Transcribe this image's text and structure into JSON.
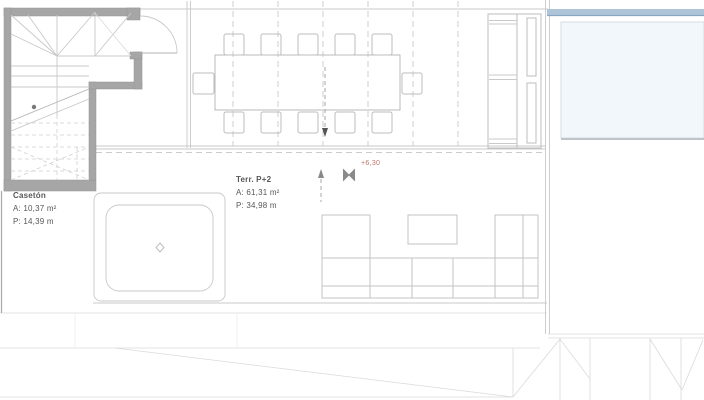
{
  "labels": {
    "caseton": {
      "name": "Casetón",
      "area": "A: 10,37 m²",
      "perimeter": "P: 14,39 m"
    },
    "terrace": {
      "name": "Terr. P+2",
      "area": "A: 61,31 m²",
      "perimeter": "P: 34,98 m"
    },
    "level": "+6,30"
  },
  "icons": {
    "level_marker": "benchmark-bowtie",
    "slope_arrow_down": "arrow-down",
    "slope_arrow_up": "arrow-up",
    "stair_direction": "dot-with-line",
    "jacuzzi_drain": "diamond"
  },
  "colors": {
    "wall_gray": "#a6a6a6",
    "plan_line_gray": "#c9c9c9",
    "level_accent_red": "#bf7368",
    "pool_edge_blue": "#aec4d9",
    "pool_water": "#f2f7fb"
  }
}
